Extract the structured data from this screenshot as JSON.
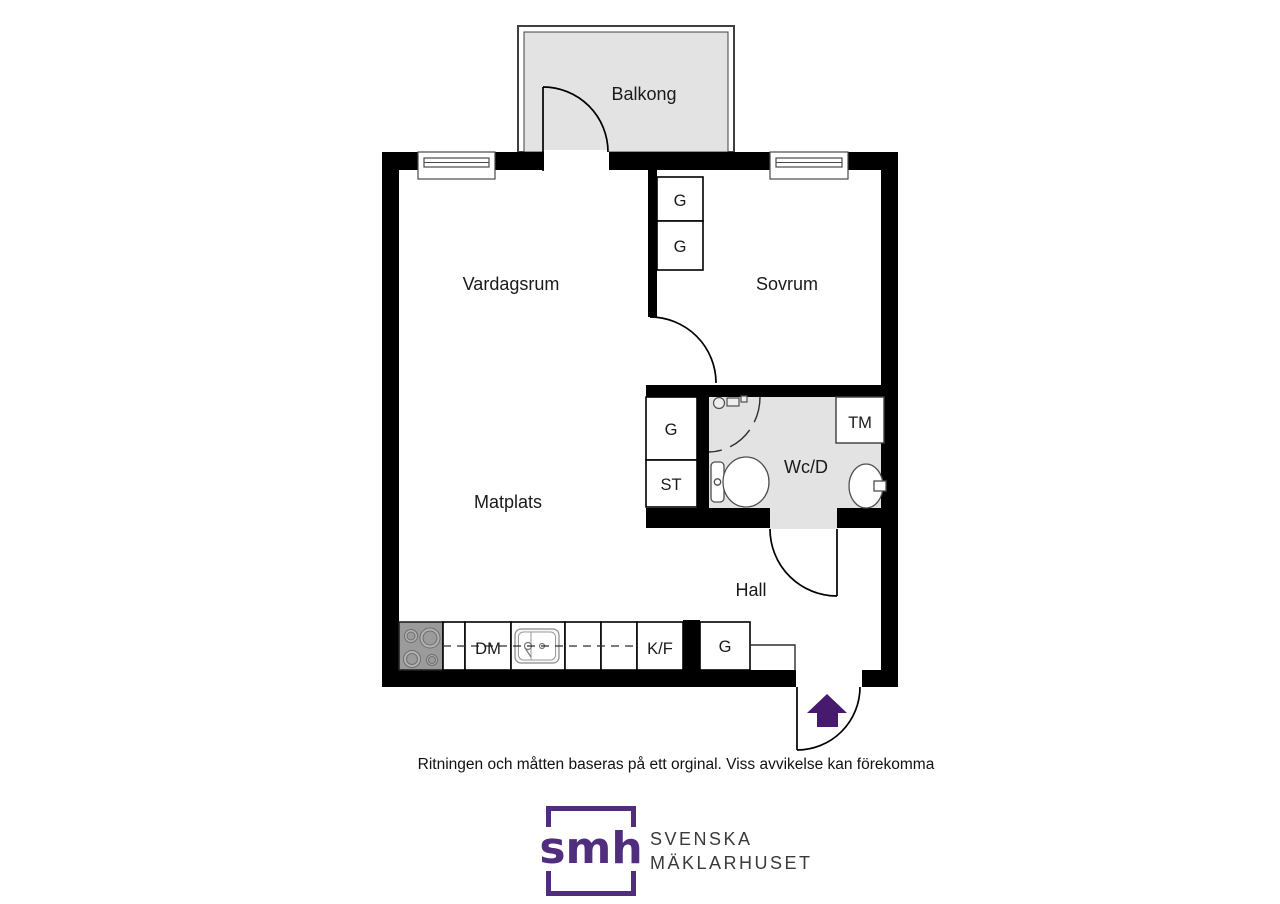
{
  "rooms": {
    "balcony": "Balkong",
    "living_room": "Vardagsrum",
    "bedroom": "Sovrum",
    "dining": "Matplats",
    "bathroom": "Wc/D",
    "hall": "Hall"
  },
  "closets": {
    "bedroom_top": "G",
    "bedroom_bottom": "G",
    "dining_g": "G",
    "dining_st": "ST",
    "hall_g": "G"
  },
  "appliances": {
    "washing_machine": "TM",
    "dishwasher": "DM",
    "fridge_freezer": "K/F"
  },
  "disclaimer": "Ritningen och måtten baseras på ett orginal. Viss avvikelse kan förekomma",
  "logo": {
    "monogram": "smh",
    "line1": "SVENSKA",
    "line2": "MÄKLARHUSET"
  },
  "colors": {
    "wall": "#000000",
    "floor_gray": "#e3e3e3",
    "accent_purple": "#471a6e",
    "logo_purple": "#512d7e",
    "logo_text": "#3a3a3e"
  }
}
